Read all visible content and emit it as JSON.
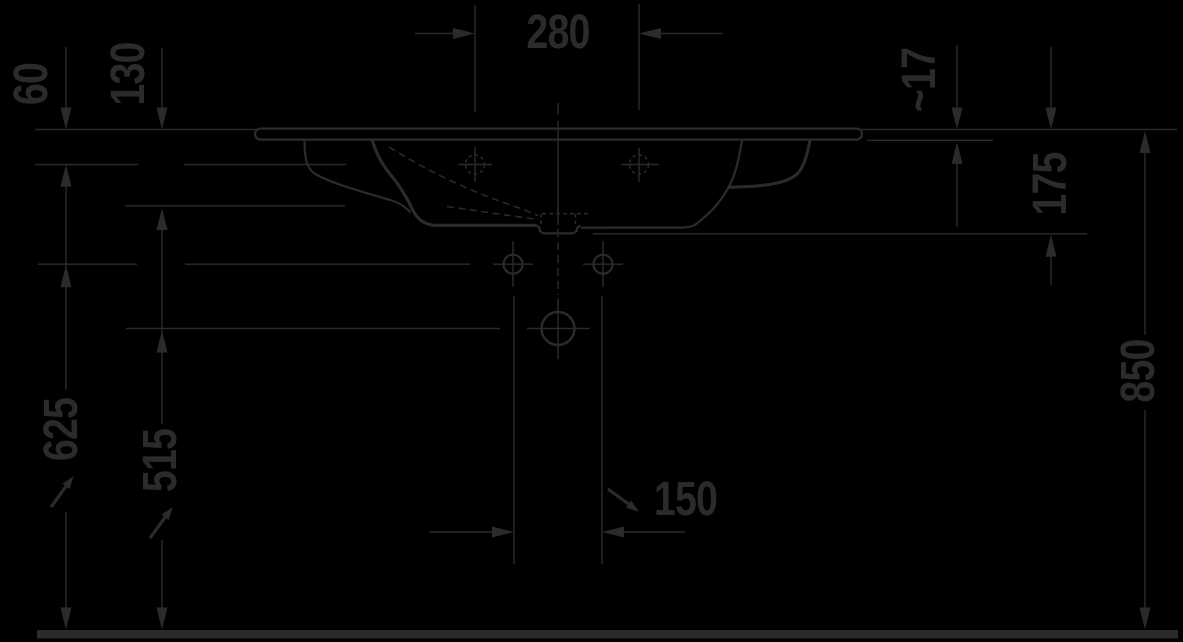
{
  "drawing": {
    "background_color": "#000000",
    "stroke_color": "#2b2b2b",
    "labels": {
      "d280": "280",
      "d60": "60",
      "d130": "130",
      "d17": "~17",
      "d175": "175",
      "d850": "850",
      "d625": "625",
      "d515": "515",
      "d150": "150"
    },
    "icons": {
      "slope_arrow": "↘"
    }
  }
}
